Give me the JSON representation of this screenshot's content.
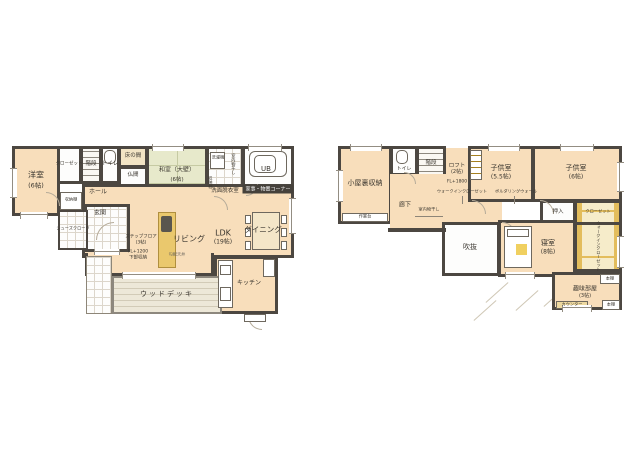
{
  "f1": {
    "yoshitsu_name": "洋室",
    "yoshitsu_size": "(6帖)",
    "closet": "クローゼット",
    "stairs": "階段",
    "toilet": "トイレ",
    "tokonoma": "床の間",
    "butsuma": "仏間",
    "washitsu_name": "和室（大壁）",
    "washitsu_size": "(6帖)",
    "washer": "洗濯機",
    "indoor_dry": "室内物干し",
    "shelf": "収納棚",
    "senmen": "洗面脱衣室",
    "ub": "UB",
    "kaji_badge": "家事・物置コーナー",
    "hall": "ホール",
    "hall_shelf": "収納棚",
    "genkan": "玄関",
    "shoes": "シューズクローク",
    "step_line1": "ステップフロア",
    "step_line2": "(3帖)",
    "step_line3": "FL+1200",
    "step_line4": "下部収納",
    "living": "リビング",
    "ldk_name": "LDK",
    "ldk_size": "(19帖)",
    "slope": "勾配天井",
    "dining": "ダイニング",
    "kitchen": "キッチン",
    "deck": "ウッドデッキ"
  },
  "f2": {
    "attic": "小屋裏収納",
    "workbench": "作業台",
    "toilet": "トイレ",
    "stairs": "階段",
    "loft_name": "ロフト",
    "loft_size": "(2帖)",
    "loft_fl": "FL+1800",
    "wic_note": "ウォークインクローゼット",
    "bouldering": "ボルダリングウォール",
    "corridor": "廊下",
    "indoor_dry": "室内物干し",
    "void": "吹抜",
    "child1_name": "子供室",
    "child1_size": "(5.5帖)",
    "child2_name": "子供室",
    "child2_size": "(6帖)",
    "oshiire": "押入",
    "closet": "クローゼット",
    "bedroom_name": "寝室",
    "bedroom_size": "(8帖)",
    "wic": "ウォークインクローゼット",
    "hobby_name": "趣味部屋",
    "hobby_size": "(3帖)",
    "counter": "カウンター",
    "shelf1": "本棚",
    "shelf2": "本棚"
  }
}
